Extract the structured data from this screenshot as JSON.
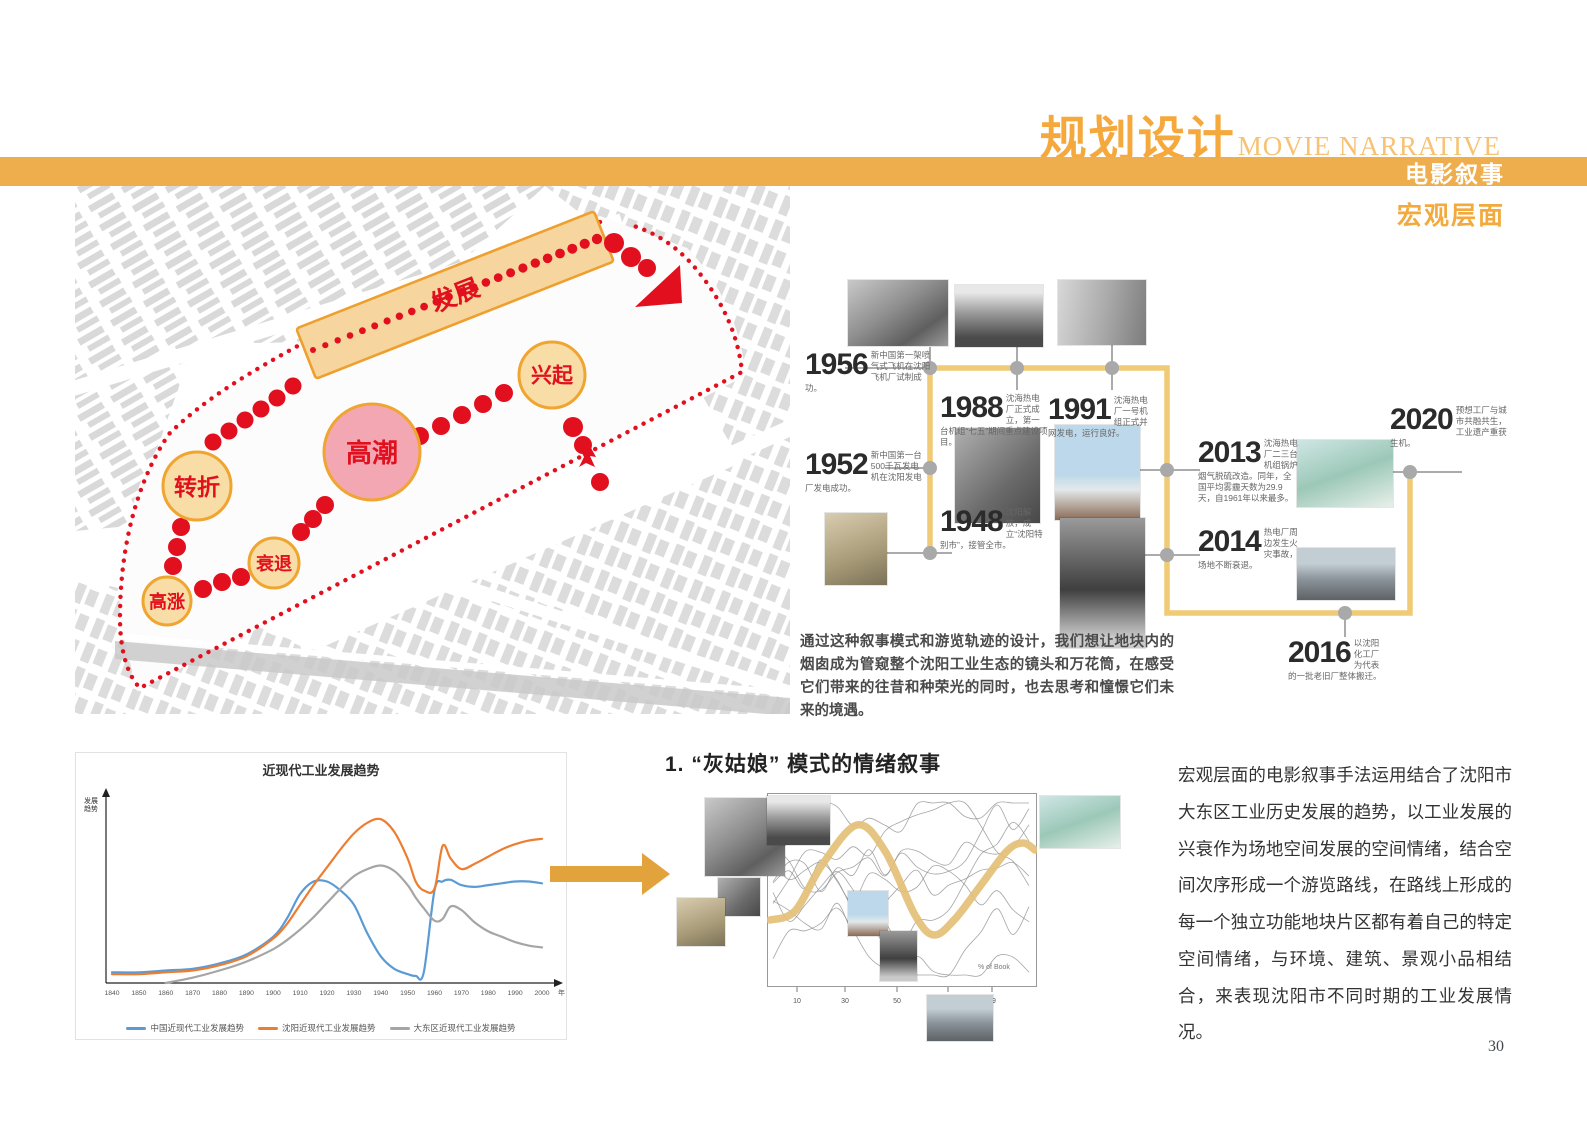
{
  "page": {
    "number": "30"
  },
  "colors": {
    "accent_orange": "#F2A93B",
    "bar_orange": "#EFAE4D",
    "route_red": "#E2101E",
    "phase_tan": "#F7DCA4",
    "phase_pink": "#F2A7B2",
    "timeline_yellow": "#F0CA74"
  },
  "header": {
    "title_cn": "规划设计",
    "title_en": "MOVIE NARRATIVE",
    "bar_label": "电影叙事",
    "sub_label": "宏观层面"
  },
  "map": {
    "phases": {
      "fazhan": "发展",
      "xingqi": "兴起",
      "gaochao": "高潮",
      "zhuanzhe": "转折",
      "shuaitui": "衰退",
      "gaozhang": "高涨"
    }
  },
  "timeline": {
    "events": [
      {
        "year": "1956",
        "note": "新中国第一架喷气式飞机在沈阳飞机厂试制成功。"
      },
      {
        "year": "1952",
        "note": "新中国第一台500千瓦发电机在沈阳发电厂发电成功。"
      },
      {
        "year": "1948",
        "note": "沈阳解放，成立“沈阳特别市”，接管全市。"
      },
      {
        "year": "1988",
        "note": "沈海热电厂正式成立，第一台机组“七五”期间重点建设项目。"
      },
      {
        "year": "1991",
        "note": "沈海热电厂一号机组正式并网发电，运行良好。"
      },
      {
        "year": "2013",
        "note": "沈海热电厂二三台机组锅炉烟气脱硫改造。同年，全国平均雾霾天数为29.9天，自1961年以来最多。"
      },
      {
        "year": "2014",
        "note": "热电厂周边发生火灾事故，场地不断衰退。"
      },
      {
        "year": "2016",
        "note": "以沈阳化工厂为代表的一批老旧厂整体搬迁。"
      },
      {
        "year": "2020",
        "note": "预想工厂与城市共融共生，工业遗产重获生机。"
      }
    ]
  },
  "narrative": {
    "text": "通过这种叙事模式和游览轨迹的设计，我们想让地块内的烟囱成为管窥整个沈阳工业生态的镜头和万花筒，在感受它们带来的往昔和种荣光的同时，也去思考和憧憬它们未来的境遇。"
  },
  "chart_data": {
    "type": "line",
    "title": "近现代工业发展趋势",
    "x": [
      1840,
      1850,
      1860,
      1870,
      1880,
      1890,
      1900,
      1905,
      1910,
      1915,
      1920,
      1925,
      1930,
      1935,
      1940,
      1945,
      1950,
      1953,
      1956,
      1960,
      1963,
      1966,
      1970,
      1975,
      1980,
      1985,
      1990,
      1995,
      2000
    ],
    "x_tick_labels": [
      "1840",
      "1850",
      "1860",
      "1870",
      "1880",
      "1890",
      "1900",
      "1910",
      "1920",
      "1930",
      "1940",
      "1950",
      "1960",
      "1970",
      "1980",
      "1990",
      "2000"
    ],
    "x_unit": "年",
    "ylabel_lines": [
      "发展",
      "趋势"
    ],
    "ylim": [
      0,
      100
    ],
    "grid": false,
    "legend_position": "bottom",
    "series": [
      {
        "name": "中国近现代工业发展趋势",
        "color": "#5B9BD5",
        "values": [
          6,
          6,
          7,
          8,
          11,
          16,
          26,
          36,
          50,
          57,
          57,
          52,
          44,
          28,
          15,
          8,
          5,
          4,
          6,
          52,
          57,
          58,
          55,
          54,
          55,
          56,
          57,
          57,
          56
        ]
      },
      {
        "name": "沈阳近现代工业发展趋势",
        "color": "#ED7D31",
        "values": [
          5,
          5,
          6,
          7,
          10,
          15,
          25,
          33,
          44,
          55,
          65,
          75,
          84,
          90,
          92,
          85,
          70,
          57,
          52,
          53,
          77,
          70,
          64,
          67,
          71,
          75,
          78,
          80,
          81
        ]
      },
      {
        "name": "大东区近现代工业发展趋势",
        "color": "#A5A5A5",
        "values": [
          null,
          null,
          0,
          3,
          7,
          12,
          19,
          24,
          30,
          37,
          45,
          53,
          60,
          64,
          66,
          63,
          55,
          48,
          42,
          35,
          36,
          43,
          41,
          34,
          29,
          26,
          23,
          21,
          20
        ]
      }
    ]
  },
  "cinderella": {
    "heading": "1. “灰姑娘” 模式的情绪叙事",
    "x_ticks": [
      "10",
      "30",
      "50",
      "70",
      "99"
    ],
    "axis_note": "% of Book"
  },
  "right_column": {
    "paragraph": "宏观层面的电影叙事手法运用结合了沈阳市大东区工业历史发展的趋势，以工业发展的兴衰作为场地空间发展的空间情绪，结合空间次序形成一个游览路线，在路线上形成的每一个独立功能地块片区都有着自己的特定空间情绪，与环境、建筑、景观小品相结合，来表现沈阳市不同时期的工业发展情况。"
  }
}
